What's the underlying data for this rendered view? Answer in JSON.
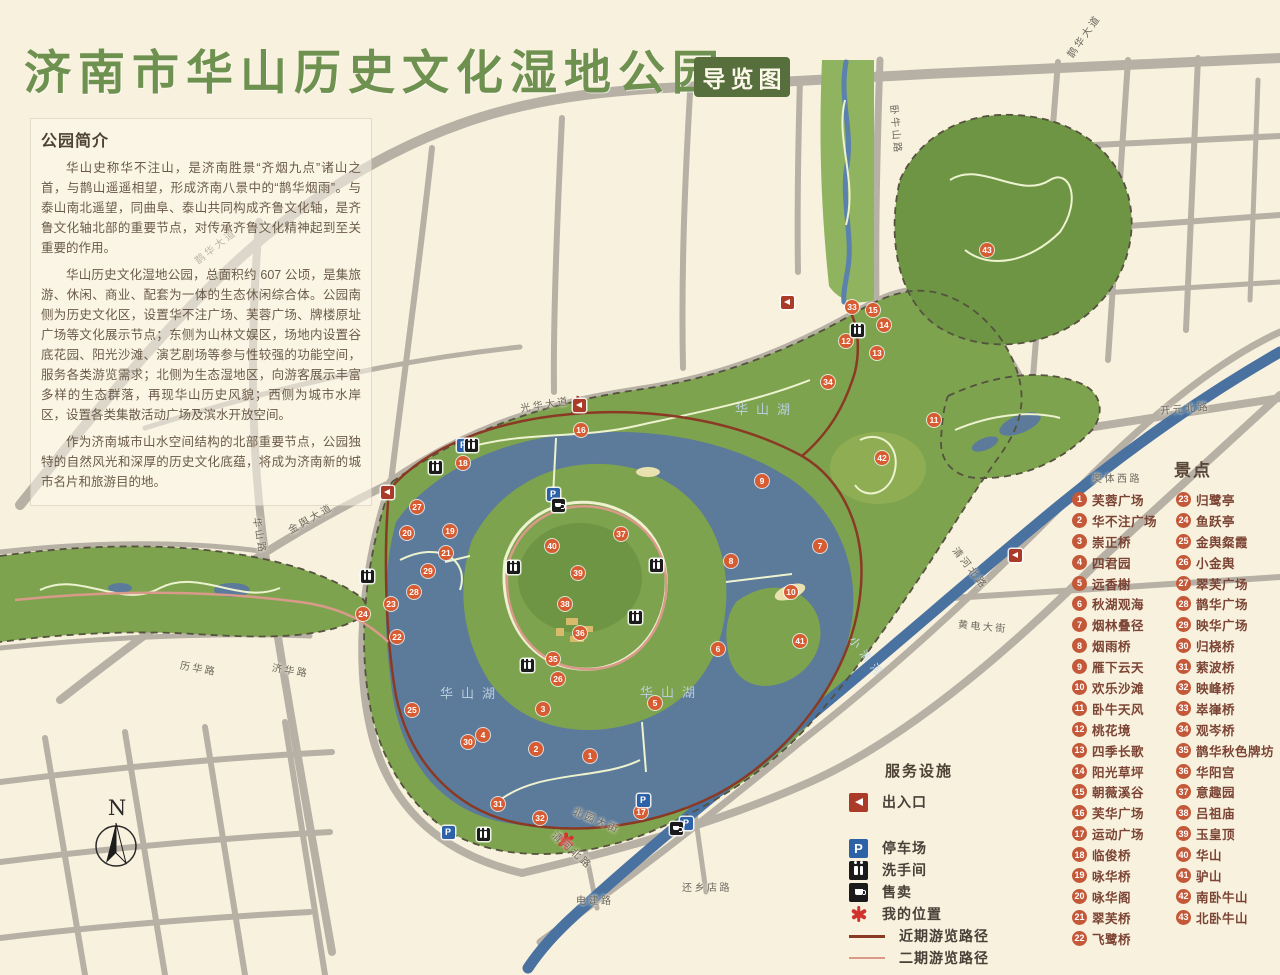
{
  "title": {
    "text": "济南市华山历史文化湿地公园",
    "badge": "导览图"
  },
  "intro": {
    "heading": "公园简介",
    "paragraphs": [
      "华山史称华不注山，是济南胜景“齐烟九点”诸山之首，与鹊山遥遥相望，形成济南八景中的“鹊华烟雨”。与泰山南北遥望，同曲阜、泰山共同构成齐鲁文化轴，是齐鲁文化轴北部的重要节点，对传承齐鲁文化精神起到至关重要的作用。",
      "华山历史文化湿地公园，总面积约 607 公顷，是集旅游、休闲、商业、配套为一体的生态休闲综合体。公园南侧为历史文化区，设置华不注广场、芙蓉广场、牌楼原址广场等文化展示节点；东侧为山林文娱区，场地内设置谷底花园、阳光沙滩、演艺剧场等参与性较强的功能空间，服务各类游览需求；北侧为生态湿地区，向游客展示丰富多样的生态群落，再现华山历史风貌；西侧为城市水岸区，设置各类集散活动广场及滨水开放空间。",
      "作为济南城市山水空间结构的北部重要节点，公园独特的自然风光和深厚的历史文化底蕴，将成为济南新的城市名片和旅游目的地。"
    ]
  },
  "scenic_legend": {
    "heading": "景点",
    "items": [
      {
        "num": 1,
        "name": "芙蓉广场"
      },
      {
        "num": 2,
        "name": "华不注广场"
      },
      {
        "num": 3,
        "name": "崇正桥"
      },
      {
        "num": 4,
        "name": "四君园"
      },
      {
        "num": 5,
        "name": "远香榭"
      },
      {
        "num": 6,
        "name": "秋湖观海"
      },
      {
        "num": 7,
        "name": "烟林叠径"
      },
      {
        "num": 8,
        "name": "烟雨桥"
      },
      {
        "num": 9,
        "name": "雁下云天"
      },
      {
        "num": 10,
        "name": "欢乐沙滩"
      },
      {
        "num": 11,
        "name": "卧牛天风"
      },
      {
        "num": 12,
        "name": "桃花境"
      },
      {
        "num": 13,
        "name": "四季长歌"
      },
      {
        "num": 14,
        "name": "阳光草坪"
      },
      {
        "num": 15,
        "name": "朝薇溪谷"
      },
      {
        "num": 16,
        "name": "芙华广场"
      },
      {
        "num": 17,
        "name": "运动广场"
      },
      {
        "num": 18,
        "name": "临俊桥"
      },
      {
        "num": 19,
        "name": "咏华桥"
      },
      {
        "num": 20,
        "name": "咏华阁"
      },
      {
        "num": 21,
        "name": "翠芙桥"
      },
      {
        "num": 22,
        "name": "飞鹭桥"
      },
      {
        "num": 23,
        "name": "归鹭亭"
      },
      {
        "num": 24,
        "name": "鱼跃亭"
      },
      {
        "num": 25,
        "name": "金舆粲霞"
      },
      {
        "num": 26,
        "name": "小金舆"
      },
      {
        "num": 27,
        "name": "翠芙广场"
      },
      {
        "num": 28,
        "name": "鹊华广场"
      },
      {
        "num": 29,
        "name": "映华广场"
      },
      {
        "num": 30,
        "name": "归桡桥"
      },
      {
        "num": 31,
        "name": "萦波桥"
      },
      {
        "num": 32,
        "name": "映峰桥"
      },
      {
        "num": 33,
        "name": "崒嵂桥"
      },
      {
        "num": 34,
        "name": "观岑桥"
      },
      {
        "num": 35,
        "name": "鹊华秋色牌坊"
      },
      {
        "num": 36,
        "name": "华阳宫"
      },
      {
        "num": 37,
        "name": "意趣园"
      },
      {
        "num": 38,
        "name": "吕祖庙"
      },
      {
        "num": 39,
        "name": "玉皇顶"
      },
      {
        "num": 40,
        "name": "华山"
      },
      {
        "num": 41,
        "name": "驴山"
      },
      {
        "num": 42,
        "name": "南卧牛山"
      },
      {
        "num": 43,
        "name": "北卧牛山"
      }
    ]
  },
  "facilities_legend": {
    "heading": "服务设施",
    "items": [
      {
        "icon": "icon-entrance",
        "label": "出入口"
      },
      {
        "icon": "icon-parking",
        "label": "停车场",
        "glyph": "P"
      },
      {
        "icon": "icon-restroom",
        "label": "洗手间"
      },
      {
        "icon": "icon-vending",
        "label": "售卖"
      },
      {
        "icon": "icon-star",
        "label": "我的位置"
      },
      {
        "icon": "route-primary",
        "label": "近期游览路径"
      },
      {
        "icon": "route-secondary",
        "label": "二期游览路径"
      }
    ]
  },
  "map": {
    "lake_labels": [
      {
        "text": "华山湖",
        "x": 735,
        "y": 399
      },
      {
        "text": "华山湖",
        "x": 440,
        "y": 683
      },
      {
        "text": "华山湖",
        "x": 640,
        "y": 682
      }
    ],
    "road_labels": [
      {
        "text": "鹊华大道",
        "x": 190,
        "y": 238,
        "rot": -38
      },
      {
        "text": "鹊华大道",
        "x": 1058,
        "y": 28,
        "rot": -55
      },
      {
        "text": "金舆大道",
        "x": 285,
        "y": 510,
        "rot": -30
      },
      {
        "text": "华山路",
        "x": 242,
        "y": 528,
        "rot": 80
      },
      {
        "text": "历华路",
        "x": 180,
        "y": 660,
        "rot": 10
      },
      {
        "text": "济华路",
        "x": 272,
        "y": 662,
        "rot": 9
      },
      {
        "text": "卧牛山路",
        "x": 872,
        "y": 122,
        "rot": 85
      },
      {
        "text": "光华大道",
        "x": 520,
        "y": 396,
        "rot": -9
      },
      {
        "text": "北园大街",
        "x": 572,
        "y": 812,
        "rot": 23
      },
      {
        "text": "开元北路",
        "x": 1160,
        "y": 400,
        "rot": -5
      },
      {
        "text": "奥体西路",
        "x": 1092,
        "y": 470,
        "rot": 0
      },
      {
        "text": "黄电大街",
        "x": 958,
        "y": 618,
        "rot": 5
      },
      {
        "text": "清河北路",
        "x": 946,
        "y": 560,
        "rot": 52
      },
      {
        "text": "清河北路",
        "x": 548,
        "y": 842,
        "rot": 42
      },
      {
        "text": "电建路",
        "x": 576,
        "y": 892,
        "rot": 0
      },
      {
        "text": "还乡店路",
        "x": 682,
        "y": 879,
        "rot": 0
      },
      {
        "text": "小清河",
        "x": 842,
        "y": 650,
        "rot": 52,
        "style": "river"
      }
    ],
    "markers": [
      {
        "num": 1,
        "x": 590,
        "y": 756
      },
      {
        "num": 2,
        "x": 536,
        "y": 749
      },
      {
        "num": 3,
        "x": 543,
        "y": 709
      },
      {
        "num": 4,
        "x": 483,
        "y": 735
      },
      {
        "num": 5,
        "x": 655,
        "y": 703
      },
      {
        "num": 6,
        "x": 718,
        "y": 649
      },
      {
        "num": 7,
        "x": 820,
        "y": 546
      },
      {
        "num": 8,
        "x": 731,
        "y": 561
      },
      {
        "num": 9,
        "x": 762,
        "y": 481
      },
      {
        "num": 10,
        "x": 791,
        "y": 592
      },
      {
        "num": 11,
        "x": 934,
        "y": 420
      },
      {
        "num": 12,
        "x": 846,
        "y": 341
      },
      {
        "num": 13,
        "x": 877,
        "y": 353
      },
      {
        "num": 14,
        "x": 884,
        "y": 325
      },
      {
        "num": 15,
        "x": 873,
        "y": 310
      },
      {
        "num": 16,
        "x": 581,
        "y": 430
      },
      {
        "num": 17,
        "x": 641,
        "y": 812
      },
      {
        "num": 18,
        "x": 463,
        "y": 463
      },
      {
        "num": 19,
        "x": 450,
        "y": 531
      },
      {
        "num": 20,
        "x": 407,
        "y": 533
      },
      {
        "num": 21,
        "x": 446,
        "y": 553
      },
      {
        "num": 22,
        "x": 397,
        "y": 637
      },
      {
        "num": 23,
        "x": 391,
        "y": 604
      },
      {
        "num": 24,
        "x": 363,
        "y": 614
      },
      {
        "num": 25,
        "x": 412,
        "y": 710
      },
      {
        "num": 26,
        "x": 558,
        "y": 679
      },
      {
        "num": 27,
        "x": 417,
        "y": 507
      },
      {
        "num": 28,
        "x": 414,
        "y": 592
      },
      {
        "num": 29,
        "x": 428,
        "y": 571
      },
      {
        "num": 30,
        "x": 468,
        "y": 742
      },
      {
        "num": 31,
        "x": 498,
        "y": 804
      },
      {
        "num": 32,
        "x": 540,
        "y": 818
      },
      {
        "num": 33,
        "x": 852,
        "y": 307
      },
      {
        "num": 34,
        "x": 828,
        "y": 382
      },
      {
        "num": 35,
        "x": 553,
        "y": 659
      },
      {
        "num": 36,
        "x": 580,
        "y": 633
      },
      {
        "num": 37,
        "x": 621,
        "y": 534
      },
      {
        "num": 38,
        "x": 565,
        "y": 604
      },
      {
        "num": 39,
        "x": 578,
        "y": 573
      },
      {
        "num": 40,
        "x": 552,
        "y": 546
      },
      {
        "num": 41,
        "x": 800,
        "y": 641
      },
      {
        "num": 42,
        "x": 882,
        "y": 458
      },
      {
        "num": 43,
        "x": 987,
        "y": 250
      }
    ],
    "facility_markers": {
      "parking": [
        {
          "x": 463,
          "y": 445
        },
        {
          "x": 553,
          "y": 494
        },
        {
          "x": 448,
          "y": 832
        },
        {
          "x": 643,
          "y": 800
        },
        {
          "x": 686,
          "y": 823
        }
      ],
      "restroom": [
        {
          "x": 435,
          "y": 467
        },
        {
          "x": 471,
          "y": 445
        },
        {
          "x": 513,
          "y": 567
        },
        {
          "x": 656,
          "y": 565
        },
        {
          "x": 635,
          "y": 617
        },
        {
          "x": 527,
          "y": 665
        },
        {
          "x": 857,
          "y": 330
        },
        {
          "x": 483,
          "y": 834
        },
        {
          "x": 367,
          "y": 576
        }
      ],
      "vending": [
        {
          "x": 558,
          "y": 505
        },
        {
          "x": 676,
          "y": 828
        }
      ],
      "entrance": [
        {
          "x": 387,
          "y": 492
        },
        {
          "x": 579,
          "y": 405
        },
        {
          "x": 787,
          "y": 302
        },
        {
          "x": 1015,
          "y": 555
        }
      ]
    },
    "my_location": {
      "x": 566,
      "y": 841
    },
    "compass_label": "N"
  },
  "colors": {
    "background": "#f8f1de",
    "title_green": "#6f9150",
    "badge_green": "#566f3d",
    "road_gray": "#b7b0a5",
    "park_green": "#7ea34f",
    "hill_green": "#6d9544",
    "lake_blue": "#5c7a99",
    "river_blue": "#4a72a0",
    "marker_orange": "#d85c32",
    "legend_number": "#c4593a",
    "legend_text": "#7c4434",
    "route_primary": "#8a3a24",
    "route_secondary": "#d99a8a"
  }
}
